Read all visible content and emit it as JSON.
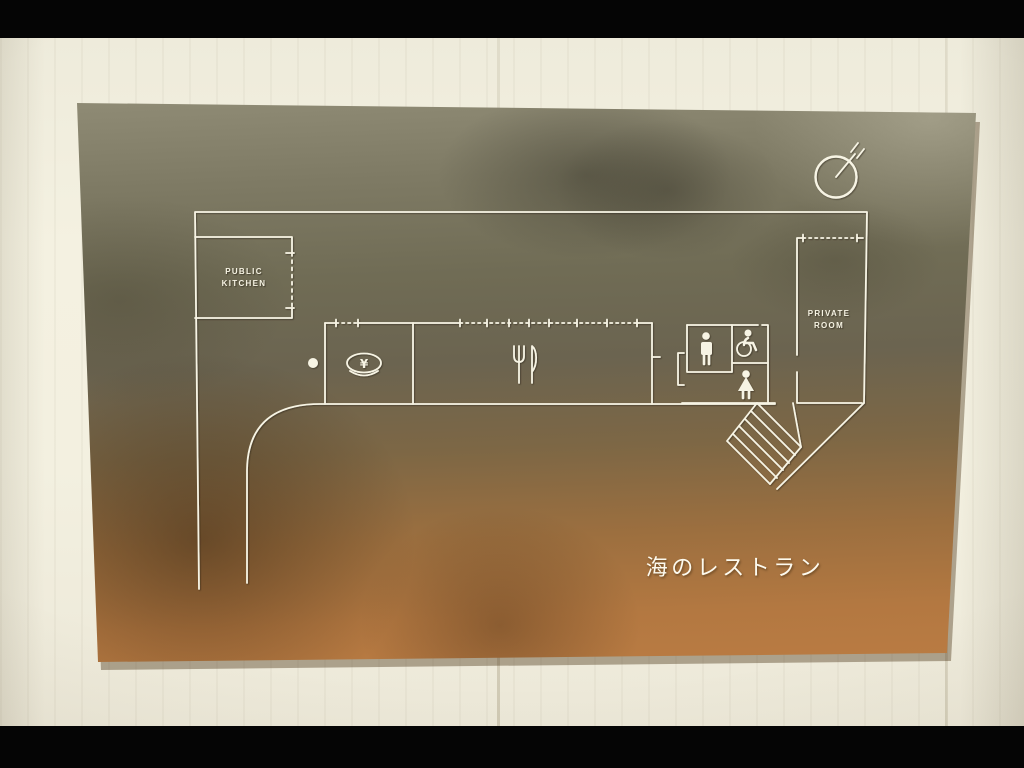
{
  "scene": {
    "letterbox_color": "#000000",
    "wall_color": "#f2efdf"
  },
  "plaque": {
    "gradient_top_color": "#95917b",
    "gradient_middle_color": "#6b6450",
    "gradient_bottom_color": "#bd7d43",
    "etch_line_color": "#f7f4e4"
  },
  "plan": {
    "rooms": [
      {
        "id": "public-kitchen",
        "line1": "PUBLIC",
        "line2": "KITCHEN"
      },
      {
        "id": "private-room",
        "line1": "PRIVATE",
        "line2": "ROOM"
      }
    ],
    "cashier_symbol": "¥",
    "icons": [
      "north-compass-icon",
      "fork-and-knife-icon",
      "rice-bowl-cashier-icon",
      "entrance-dot",
      "male-figure-icon",
      "wheelchair-icon",
      "female-figure-icon",
      "stairs"
    ]
  },
  "title": {
    "text": "海のレストラン"
  }
}
